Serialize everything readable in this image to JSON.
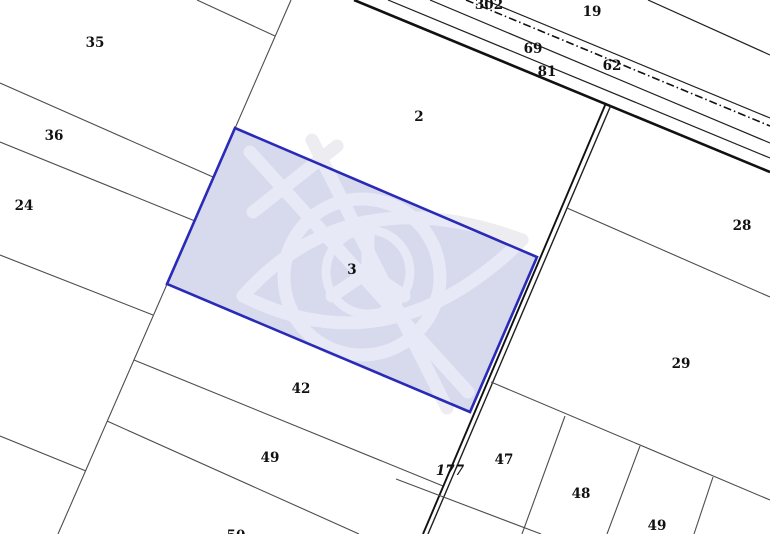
{
  "map": {
    "width": 770,
    "height": 534,
    "background": "#ffffff",
    "colors": {
      "boundary": "#4d4d4d",
      "road": "#1f1f1f",
      "road_thick": "#111111",
      "selected_fill": "#d7d9ec",
      "selected_stroke": "#2a2ab8",
      "label": "#111111",
      "watermark_outside": "#ededf1",
      "watermark_inside": "#e7e9f6"
    },
    "selected_parcel": {
      "id": "3",
      "points": "235,128 537,257 470,412 167,284",
      "label": {
        "text": "3",
        "x": 352,
        "y": 274
      }
    },
    "lines": [
      {
        "name": "boundary-ne-corner",
        "x1": 648,
        "y1": 0,
        "x2": 770,
        "y2": 55,
        "w": 1.2,
        "c": "road"
      },
      {
        "name": "road-edge-north",
        "x1": 485,
        "y1": 0,
        "x2": 770,
        "y2": 118,
        "w": 1.2,
        "c": "road"
      },
      {
        "name": "road-centerline-dashdot",
        "x1": 466,
        "y1": 0,
        "x2": 770,
        "y2": 126,
        "w": 1.6,
        "c": "road_thick",
        "dash": "8 3 1.5 3"
      },
      {
        "name": "road-lane-line-1",
        "x1": 430,
        "y1": 0,
        "x2": 770,
        "y2": 143,
        "w": 1.2,
        "c": "road"
      },
      {
        "name": "road-lane-line-2",
        "x1": 388,
        "y1": 0,
        "x2": 770,
        "y2": 158,
        "w": 1.2,
        "c": "road"
      },
      {
        "name": "road-edge-south-thick",
        "x1": 354,
        "y1": 0,
        "x2": 770,
        "y2": 172,
        "w": 2.6,
        "c": "road_thick"
      },
      {
        "name": "boundary-west-long",
        "x1": 291,
        "y1": 0,
        "x2": 58,
        "y2": 534,
        "w": 1.1,
        "c": "boundary"
      },
      {
        "name": "boundary-nw-corner",
        "x1": 197,
        "y1": 0,
        "x2": 275,
        "y2": 36,
        "w": 1.1,
        "c": "boundary"
      },
      {
        "name": "boundary-35-36",
        "x1": 0,
        "y1": 83,
        "x2": 213,
        "y2": 177,
        "w": 1.1,
        "c": "boundary"
      },
      {
        "name": "boundary-36-24",
        "x1": 0,
        "y1": 142,
        "x2": 195,
        "y2": 221,
        "w": 1.1,
        "c": "boundary"
      },
      {
        "name": "boundary-24-south",
        "x1": 0,
        "y1": 255,
        "x2": 153,
        "y2": 315,
        "w": 1.1,
        "c": "boundary"
      },
      {
        "name": "boundary-left-lower",
        "x1": 0,
        "y1": 436,
        "x2": 86,
        "y2": 471,
        "w": 1.1,
        "c": "boundary"
      },
      {
        "name": "boundary-42-49",
        "x1": 134,
        "y1": 360,
        "x2": 443,
        "y2": 486,
        "w": 1.1,
        "c": "boundary"
      },
      {
        "name": "boundary-49-50",
        "x1": 107,
        "y1": 421,
        "x2": 359,
        "y2": 534,
        "w": 1.1,
        "c": "boundary"
      },
      {
        "name": "road-177-west-line",
        "x1": 606,
        "y1": 103,
        "x2": 423,
        "y2": 534,
        "w": 1.9,
        "c": "road_thick"
      },
      {
        "name": "road-177-east-line",
        "x1": 611,
        "y1": 105,
        "x2": 428,
        "y2": 534,
        "w": 1.4,
        "c": "road"
      },
      {
        "name": "boundary-28-29",
        "x1": 567,
        "y1": 208,
        "x2": 770,
        "y2": 297,
        "w": 1.1,
        "c": "boundary"
      },
      {
        "name": "boundary-29-47row",
        "x1": 491,
        "y1": 382,
        "x2": 770,
        "y2": 500,
        "w": 1.1,
        "c": "boundary"
      },
      {
        "name": "boundary-47-48",
        "x1": 565,
        "y1": 416,
        "x2": 522,
        "y2": 534,
        "w": 1.1,
        "c": "boundary"
      },
      {
        "name": "boundary-48-49",
        "x1": 640,
        "y1": 446,
        "x2": 607,
        "y2": 534,
        "w": 1.1,
        "c": "boundary"
      },
      {
        "name": "boundary-49-east",
        "x1": 713,
        "y1": 477,
        "x2": 694,
        "y2": 534,
        "w": 1.1,
        "c": "boundary"
      },
      {
        "name": "boundary-bottom-cross",
        "x1": 396,
        "y1": 479,
        "x2": 541,
        "y2": 534,
        "w": 1.1,
        "c": "boundary"
      }
    ],
    "labels": [
      {
        "text": "35",
        "x": 95,
        "y": 47
      },
      {
        "text": "36",
        "x": 54,
        "y": 140
      },
      {
        "text": "24",
        "x": 24,
        "y": 210
      },
      {
        "text": "2",
        "x": 419,
        "y": 121
      },
      {
        "text": "42",
        "x": 301,
        "y": 393
      },
      {
        "text": "49",
        "x": 270,
        "y": 462
      },
      {
        "text": "50",
        "x": 236,
        "y": 540
      },
      {
        "text": "302",
        "x": 489,
        "y": 9
      },
      {
        "text": "19",
        "x": 592,
        "y": 16
      },
      {
        "text": "69",
        "x": 533,
        "y": 53
      },
      {
        "text": "81",
        "x": 547,
        "y": 76
      },
      {
        "text": "62",
        "x": 612,
        "y": 70
      },
      {
        "text": "28",
        "x": 742,
        "y": 230
      },
      {
        "text": "29",
        "x": 681,
        "y": 368
      },
      {
        "text": "47",
        "x": 504,
        "y": 464
      },
      {
        "text": "48",
        "x": 581,
        "y": 498
      },
      {
        "text": "49",
        "x": 657,
        "y": 530
      },
      {
        "text": "177",
        "x": 450,
        "y": 475,
        "italic": true
      }
    ],
    "watermark": {
      "stroke_width": 13,
      "paths": [
        "M 250 152 L 468 392",
        "M 312 140 L 447 408",
        "M 253 212 L 337 146",
        "M 243 296 Q 350 176 522 240",
        "M 243 296 Q 390 370 522 240",
        "M 368 230 L 368 272 M 368 272 L 332 296 M 368 272 L 404 296"
      ],
      "circles": [
        {
          "cx": 362,
          "cy": 277,
          "r": 78,
          "w": 13
        },
        {
          "cx": 368,
          "cy": 272,
          "r": 42,
          "w": 9
        }
      ]
    }
  }
}
